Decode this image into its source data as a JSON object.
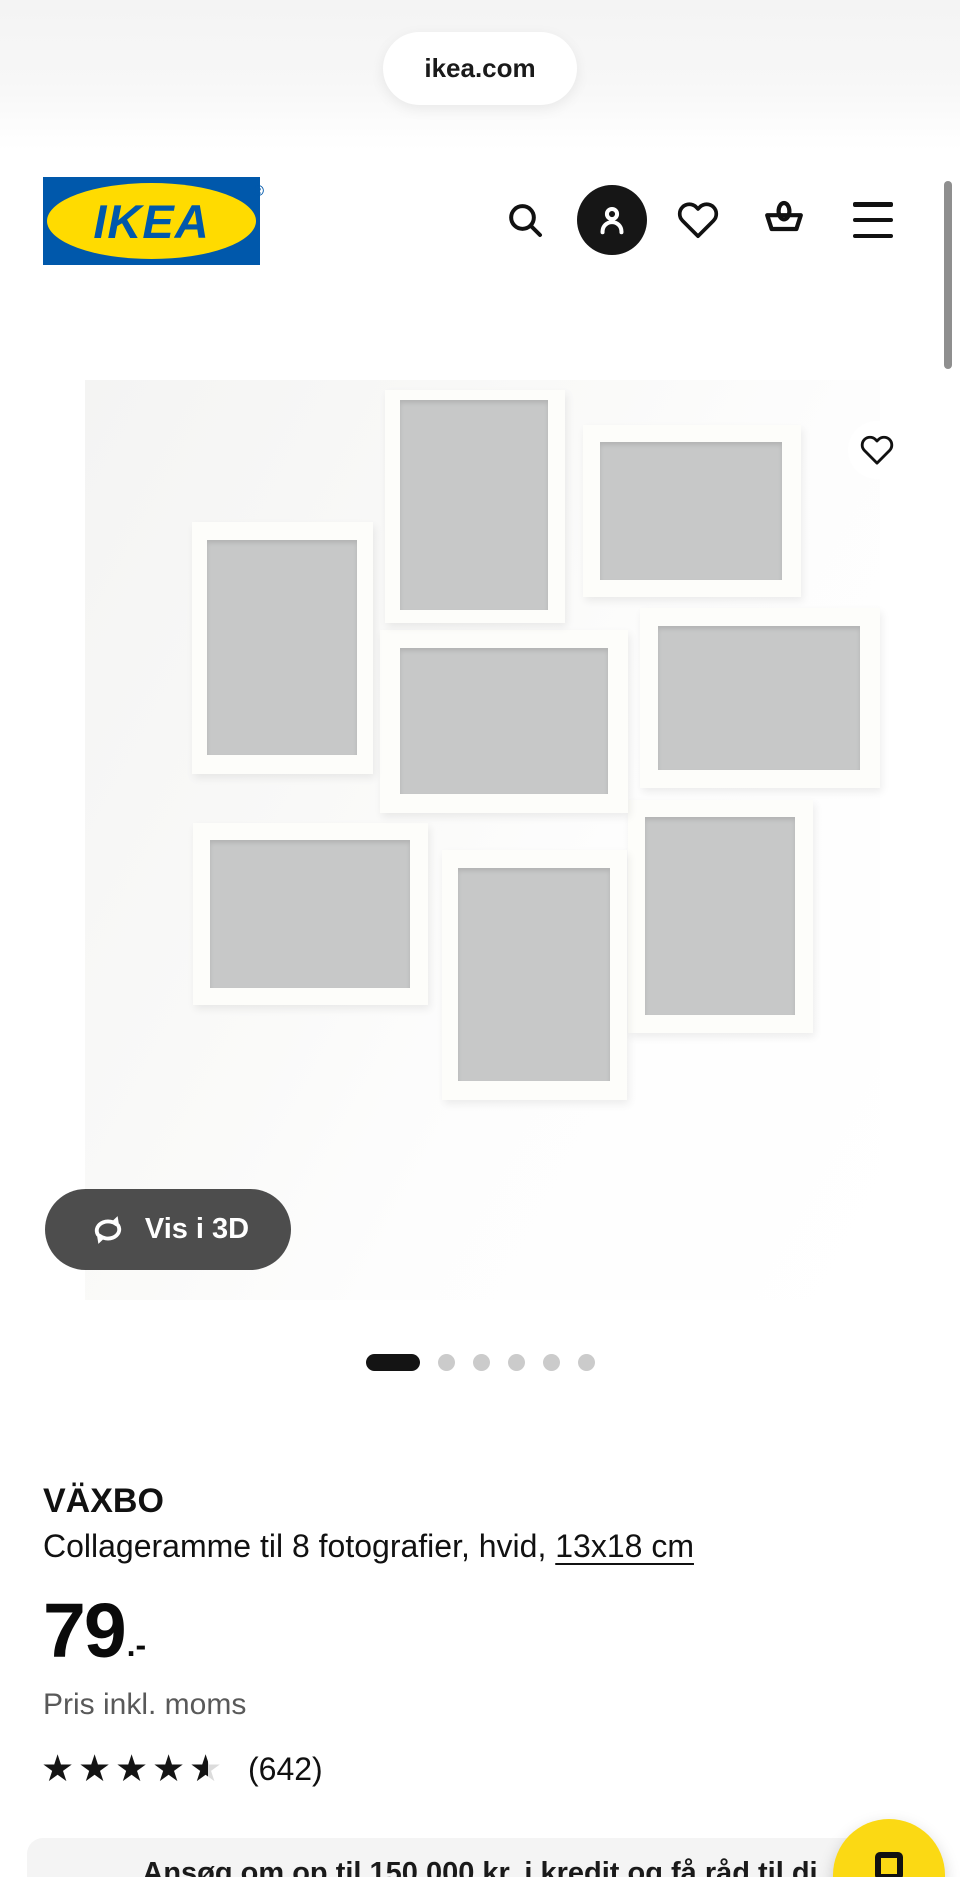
{
  "browser": {
    "url_pill": "ikea.com"
  },
  "header": {
    "logo_text": "IKEA",
    "logo_reg": "®",
    "icons": [
      "search-icon",
      "profile-icon",
      "favorites-heart-icon",
      "shopping-basket-icon",
      "menu-icon"
    ]
  },
  "colors": {
    "ikea_blue": "#0058AB",
    "ikea_yellow": "#FFDB00",
    "fab_yellow": "#FBD914",
    "btn_3d_gray": "#4D4D4D",
    "frame_opening_gray": "#C7C8C8",
    "inactive_dot": "#CBCBCB",
    "muted_text": "#595959"
  },
  "gallery": {
    "view_3d_label": "Vis i 3D",
    "view_3d_icon": "rotate-3d-icon",
    "favorite_icon": "heart-outline-icon",
    "indicator_count": 6,
    "active_indicator": 0,
    "frames": [
      {
        "f": [
          300,
          10,
          180,
          233
        ],
        "o": [
          315,
          20,
          148,
          210
        ]
      },
      {
        "f": [
          498,
          45,
          218,
          172
        ],
        "o": [
          515,
          62,
          182,
          138
        ]
      },
      {
        "f": [
          107,
          142,
          181,
          252
        ],
        "o": [
          122,
          160,
          150,
          215
        ]
      },
      {
        "f": [
          295,
          250,
          248,
          183
        ],
        "o": [
          315,
          268,
          208,
          146
        ]
      },
      {
        "f": [
          555,
          228,
          240,
          180
        ],
        "o": [
          573,
          246,
          202,
          144
        ]
      },
      {
        "f": [
          108,
          443,
          235,
          182
        ],
        "o": [
          125,
          460,
          200,
          148
        ]
      },
      {
        "f": [
          357,
          470,
          185,
          250
        ],
        "o": [
          373,
          488,
          152,
          213
        ]
      },
      {
        "f": [
          543,
          420,
          185,
          233
        ],
        "o": [
          560,
          437,
          150,
          198
        ]
      }
    ]
  },
  "product": {
    "name": "VÄXBO",
    "description": "Collageramme til 8 fotografier, hvid, ",
    "size_link": "13x18 cm",
    "price": "79",
    "price_suffix": ".-",
    "price_note": "Pris inkl. moms",
    "rating": {
      "value": 4.5,
      "max": 5,
      "count_label": "(642)"
    }
  },
  "promo_banner": {
    "text": "Ansøg om op til 150.000 kr. i kredit og få råd til di"
  },
  "fab": {
    "icon": "square-outline-icon"
  }
}
